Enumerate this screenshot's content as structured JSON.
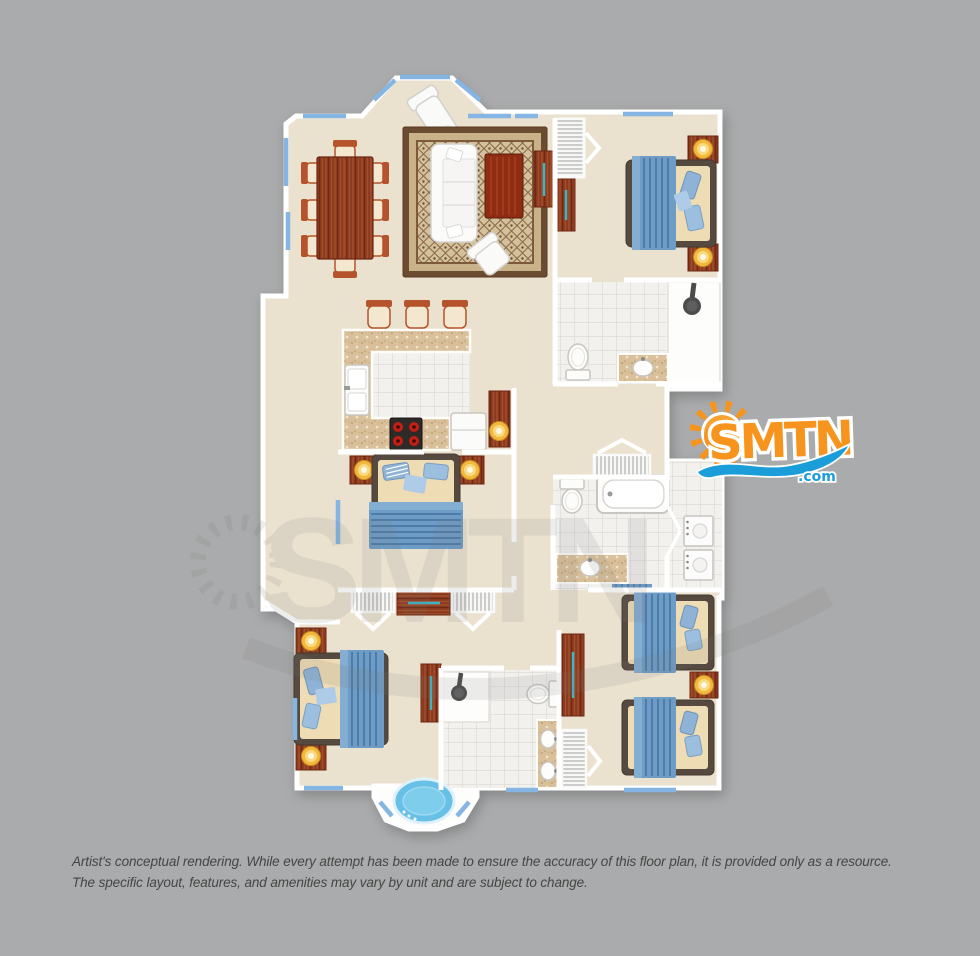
{
  "canvas": {
    "width": 980,
    "height": 956,
    "background": "#aaabac"
  },
  "logo": {
    "text": "SMTN",
    "tld": ".com",
    "sun_color": "#f7941d",
    "text_color": "#f7941d",
    "wave_color": "#1b9dd9",
    "outline_color": "#ffffff"
  },
  "watermark": {
    "text": "SMTN"
  },
  "disclaimer": {
    "line1": "Artist's conceptual rendering. While every attempt has been made to ensure the accuracy of this floor plan, it is provided only as a resource.",
    "line2": "The specific layout, features, and amenities may vary by unit and are subject to change."
  },
  "floor_plan": {
    "palette": {
      "floor": "#ebe1cf",
      "walls": "#ffffff",
      "window_blue": "#84b5e3",
      "balcony": "#dadbdc",
      "tile": "#f2f1ee",
      "counter_granite": "#d9c09a",
      "wood_red": "#8c3a1f",
      "bed_blanket_blue": "#6d9cc6",
      "bed_frame": "#564a40",
      "mattress": "#eedcb4",
      "lamp_glow": "#f2b93c",
      "tub_water": "#67c0e6",
      "stove_burner": "#c21f15",
      "accent_teal": "#3fb5c4"
    },
    "rooms": [
      "balcony",
      "dining-area",
      "living-room",
      "kitchen",
      "hallway",
      "bedroom-top-right",
      "bathroom-top",
      "master-bedroom",
      "bathroom-middle",
      "laundry",
      "bedroom-bottom-left",
      "bathroom-bottom",
      "bedroom-bottom-right",
      "jacuzzi-bay"
    ],
    "furniture_icons": [
      "dining-table",
      "dining-chair",
      "bar-stool",
      "chaise-lounge",
      "sofa",
      "armchair",
      "area-rug",
      "coffee-table",
      "media-console",
      "louvered-closet",
      "kitchen-counter",
      "kitchen-sink",
      "stove",
      "refrigerator",
      "bed",
      "nightstand",
      "table-lamp",
      "dresser",
      "toilet",
      "vanity-sink",
      "bathtub",
      "shower",
      "washer",
      "dryer",
      "jacuzzi-tub",
      "bath-mat"
    ]
  }
}
